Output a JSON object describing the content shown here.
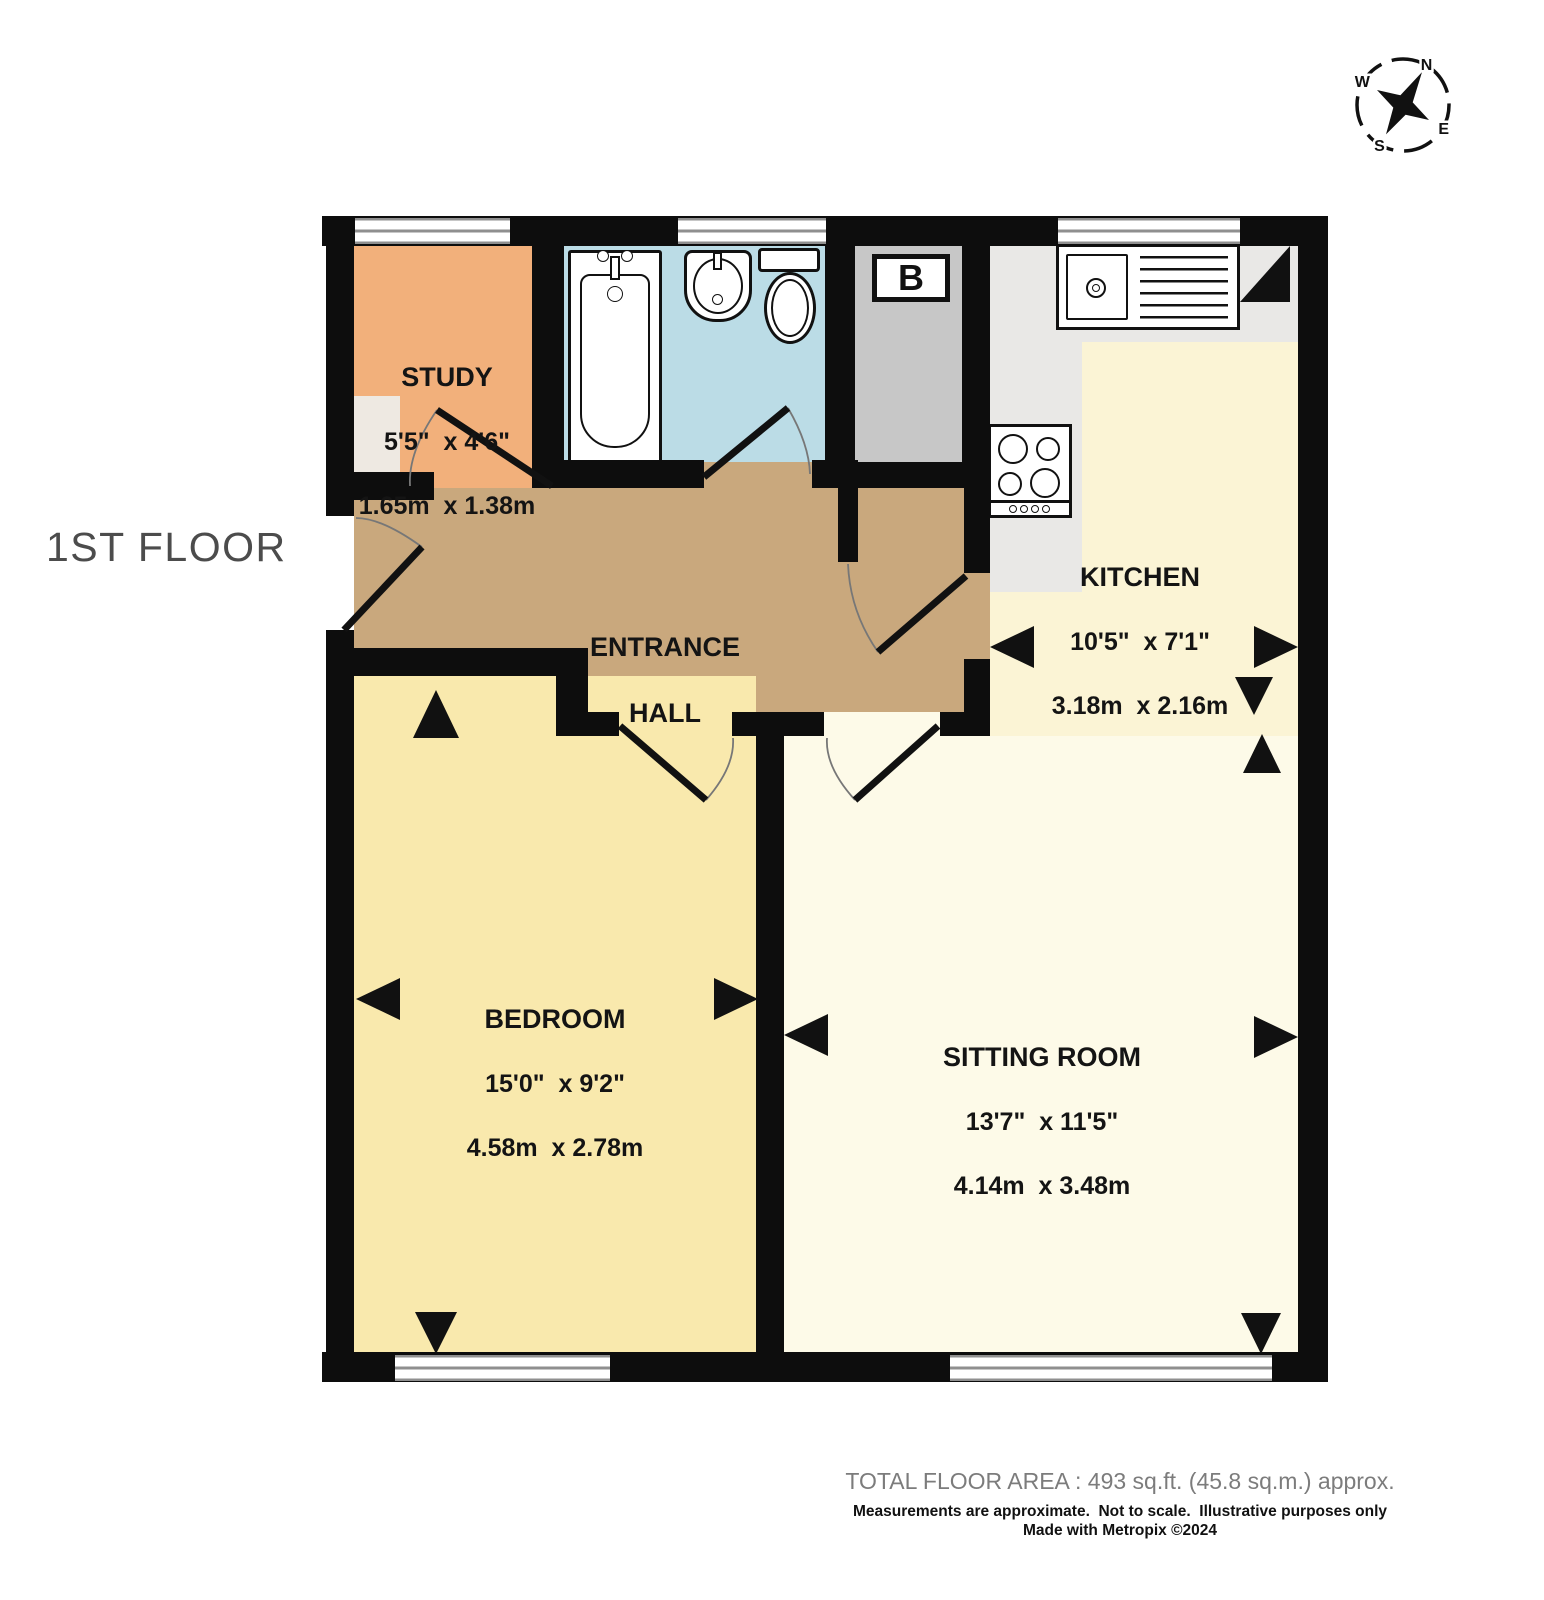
{
  "floor_title": "1ST FLOOR",
  "compass": {
    "n": "N",
    "e": "E",
    "s": "S",
    "w": "W"
  },
  "rooms": {
    "study": {
      "name": "STUDY",
      "dims_imperial": "5'5\"  x 4'6\"",
      "dims_metric": "1.65m  x 1.38m"
    },
    "entrance_hall": {
      "name_line1": "ENTRANCE",
      "name_line2": "HALL"
    },
    "kitchen": {
      "name": "KITCHEN",
      "dims_imperial": "10'5\"  x 7'1\"",
      "dims_metric": "3.18m  x 2.16m"
    },
    "bedroom": {
      "name": "BEDROOM",
      "dims_imperial": "15'0\"  x 9'2\"",
      "dims_metric": "4.58m  x 2.78m"
    },
    "sitting_room": {
      "name": "SITTING ROOM",
      "dims_imperial": "13'7\"  x 11'5\"",
      "dims_metric": "4.14m  x 3.48m"
    },
    "boiler": {
      "label": "B"
    }
  },
  "footer": {
    "total_area": "TOTAL FLOOR AREA : 493 sq.ft. (45.8 sq.m.) approx.",
    "disclaimer": "Measurements are approximate.  Not to scale.  Illustrative purposes only",
    "credit": "Made with Metropix ©2024"
  },
  "colors": {
    "wall": "#0d0d0d",
    "study": "#f2b07b",
    "bathroom": "#bbdce6",
    "boiler_cupboard": "#c7c7c7",
    "entrance_hall": "#c9a87d",
    "bedroom": "#f9e9ad",
    "kitchen": "#fbf4d5",
    "sitting_room": "#fdfae8",
    "counter": "#e9e8e6"
  }
}
